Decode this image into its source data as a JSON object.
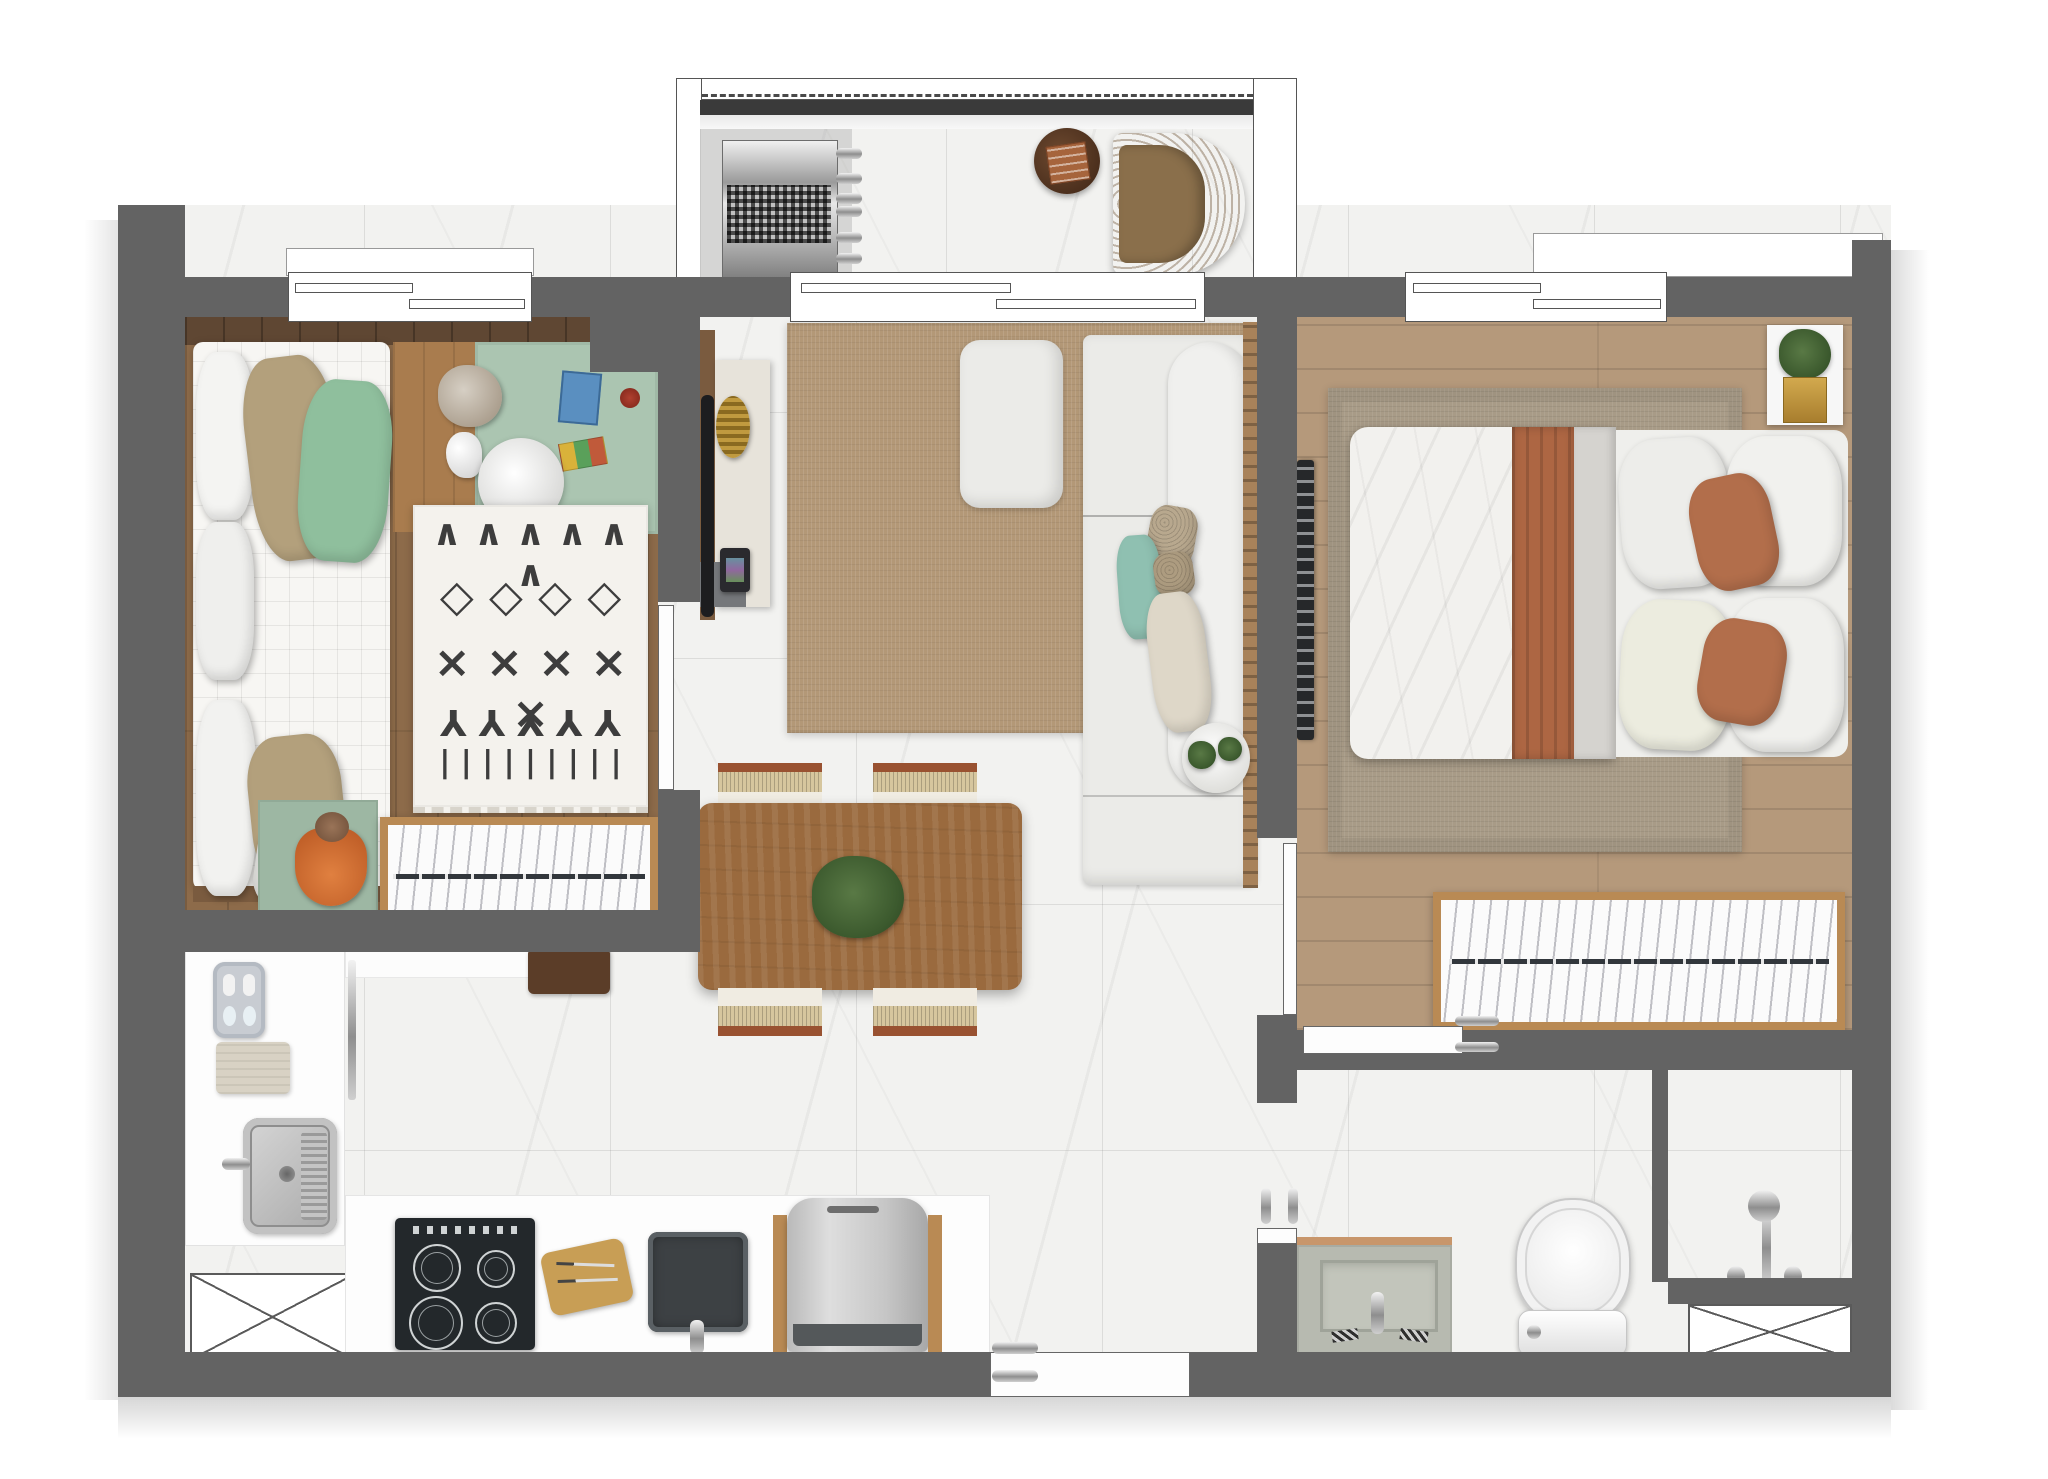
{
  "title": "apartment-floor-plan-top-view",
  "palette": {
    "wall": "#636363",
    "marble": "#f2f2f0",
    "wood_mid": "#8d6b4a",
    "wood_dark": "#5f4733",
    "wood_light": "#b5997b",
    "table_wood": "#9a6a3e",
    "closet_frame": "#b98a54",
    "rug_ivory": "#f4f2ed",
    "rug_pattern": "#3d3d3d",
    "rug_living": "#b39877",
    "rug_master": "#a89b87",
    "sage": "#9db7a3",
    "desk_green": "#abc5b1",
    "terracotta": "#ad6643",
    "pillow_gold": "#b3a07c",
    "pillow_green": "#8fbf9d",
    "pillow_teal": "#8fc0b1",
    "cooktop": "#23282b",
    "appliance": "#c9c9c9",
    "rattan": "#c89a62"
  },
  "rooms": [
    {
      "id": "balcony",
      "label": "Balcony"
    },
    {
      "id": "bedroom-1",
      "label": "Bedroom 1"
    },
    {
      "id": "living-dining",
      "label": "Living / Dining"
    },
    {
      "id": "kitchen",
      "label": "Kitchen"
    },
    {
      "id": "hallway",
      "label": "Hallway"
    },
    {
      "id": "master-bedroom",
      "label": "Master Bedroom"
    },
    {
      "id": "bathroom",
      "label": "Bathroom"
    }
  ],
  "furniture": {
    "balcony": [
      "ac-condenser-unit",
      "round-side-table",
      "wicker-armchair"
    ],
    "bedroom_1": [
      "single-bed",
      "desk-with-toys",
      "desk-chair",
      "patterned-rug",
      "play-mat-with-plush",
      "wardrobe"
    ],
    "living_dining": [
      "tv-panel",
      "sideboard",
      "media-speaker",
      "jute-rug",
      "ottoman",
      "sofa-with-pillows",
      "wood-slat-panel",
      "succulent-plate",
      "dining-table",
      "table-plant",
      "dining-chairs-x4"
    ],
    "kitchen": [
      "counter",
      "soap-tray",
      "towel",
      "steel-sink",
      "washer-space-marker",
      "induction-cooktop",
      "cutting-boards",
      "square-sink",
      "refrigerator"
    ],
    "master_bedroom": [
      "wall-tv-panel",
      "area-rug",
      "double-bed",
      "terracotta-throw",
      "pillows",
      "plant-shelf",
      "wardrobe"
    ],
    "bathroom": [
      "vanity-with-basin",
      "toilet",
      "shower-mixer",
      "shower-partition",
      "shower-tray-marker"
    ]
  },
  "rug_pattern_rows": {
    "r1": "∧ ∧ ∧ ∧ ∧ ∧",
    "r2": "◇ ◇ ◇ ◇",
    "r3": "× × × × ×",
    "r4": "Y Y Y Y Y",
    "r5": "| | | | | | | | |"
  }
}
